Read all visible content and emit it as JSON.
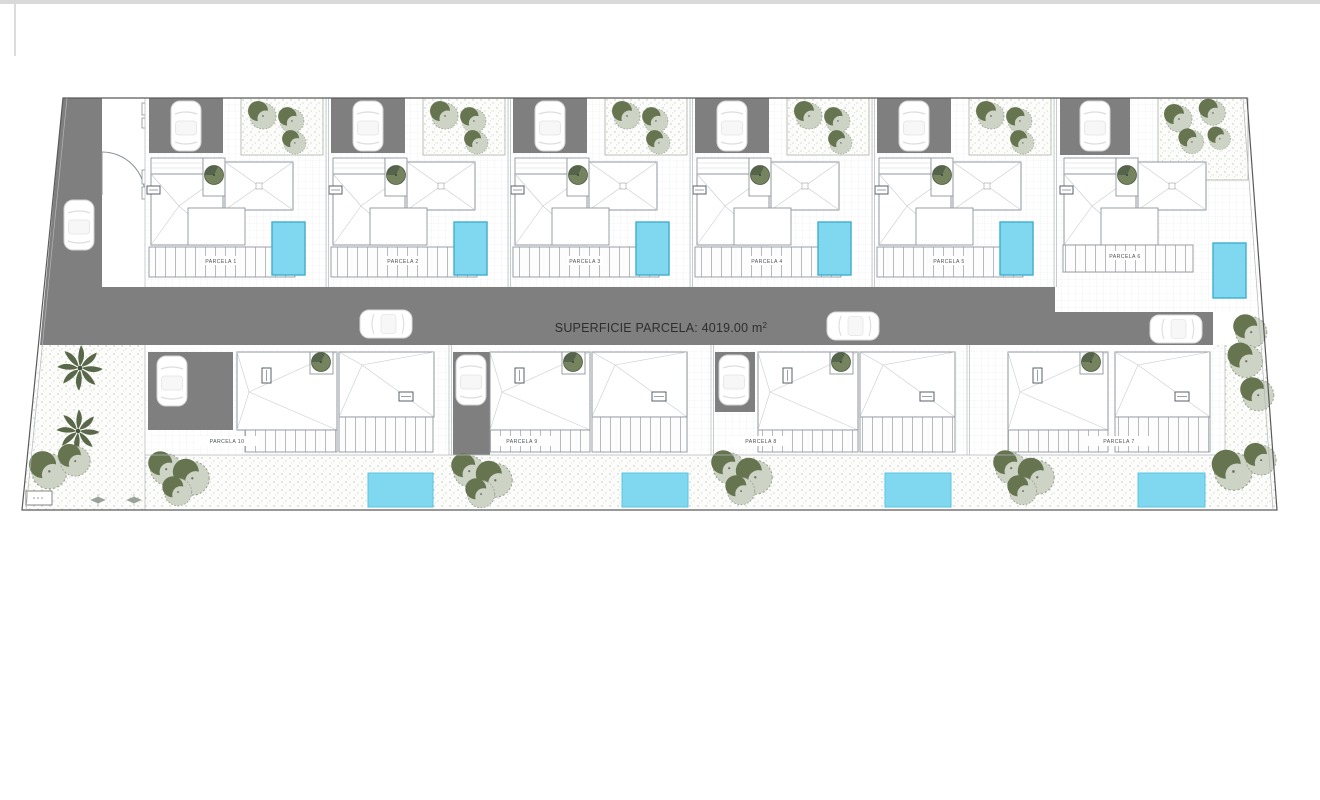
{
  "page": {
    "topbar_color": "#d9d9d9",
    "background": "#ffffff"
  },
  "plan": {
    "road": {
      "label_text": "SUPERFICIE PARCELA: 4019.00 m",
      "label_superscript": "2"
    },
    "colors": {
      "road": "#7f7f7f",
      "driveway": "#7f7f7f",
      "pool_fill": "#7fd7f0",
      "pool_border": "#41aecd",
      "tree_dark": "#66754f",
      "tree_light": "#cdd3c5",
      "palm_green": "#5a684a",
      "outline": "#8f969c",
      "boundary": "#5a5a5a",
      "label_text_color": "#4c5257"
    },
    "parcels": [
      {
        "id": 1,
        "label": "PARCELA 1"
      },
      {
        "id": 2,
        "label": "PARCELA 2"
      },
      {
        "id": 3,
        "label": "PARCELA 3"
      },
      {
        "id": 4,
        "label": "PARCELA 4"
      },
      {
        "id": 5,
        "label": "PARCELA 5"
      },
      {
        "id": 6,
        "label": "PARCELA 6"
      },
      {
        "id": 7,
        "label": "PARCELA 7"
      },
      {
        "id": 8,
        "label": "PARCELA 8"
      },
      {
        "id": 9,
        "label": "PARCELA 9"
      },
      {
        "id": 10,
        "label": "PARCELA 10"
      }
    ]
  }
}
